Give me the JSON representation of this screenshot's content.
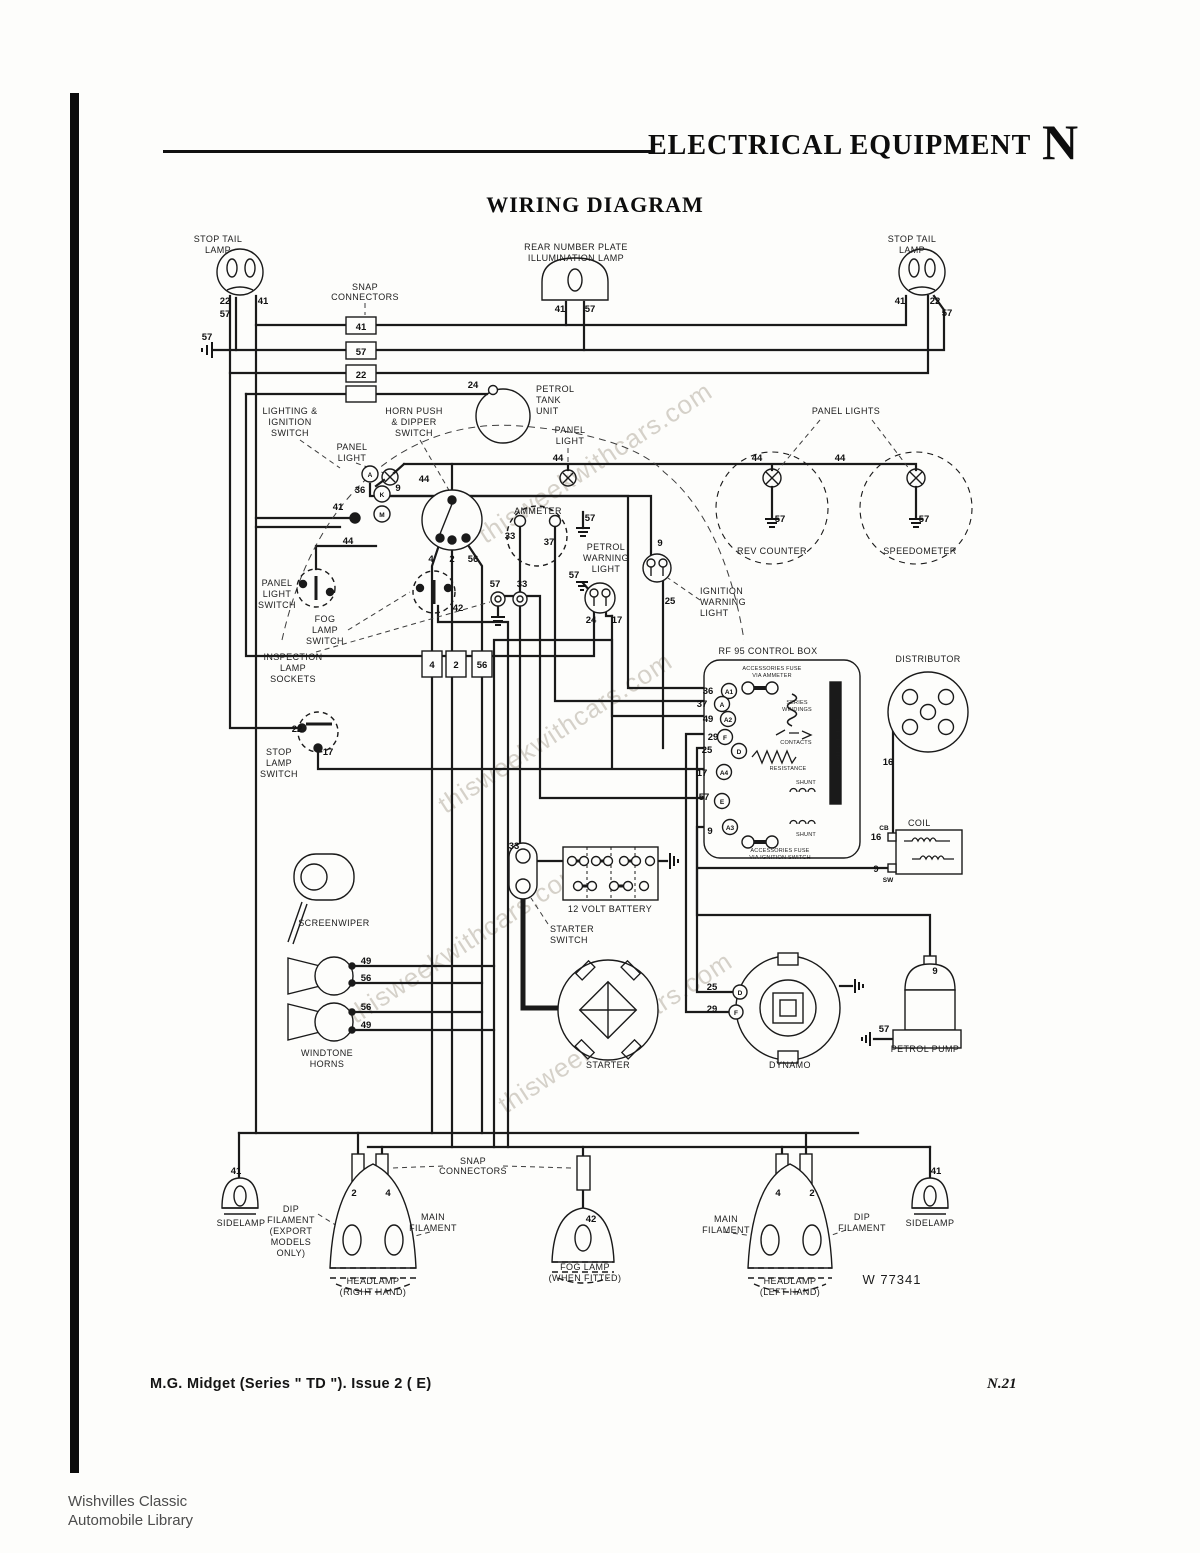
{
  "page": {
    "header": {
      "title": "ELECTRICAL EQUIPMENT",
      "section_letter": "N"
    },
    "diagram_title": "WIRING DIAGRAM",
    "footer": {
      "model_line": "M.G. Midget (Series \" TD \").  Issue 2 ( E)",
      "page_number": "N.21"
    },
    "stamp": {
      "line1": "Wishvilles Classic",
      "line2": "Automobile Library"
    },
    "watermark": "thisweekwithcars.com",
    "drawing_number": "W 77341"
  },
  "labels": {
    "stop_tail_lamp_left": [
      "STOP TAIL",
      "LAMP"
    ],
    "snap_connectors_top": [
      "SNAP",
      "CONNECTORS"
    ],
    "rear_number_plate_lamp": [
      "REAR NUMBER PLATE",
      "ILLUMINATION LAMP"
    ],
    "stop_tail_lamp_right": [
      "STOP TAIL",
      "LAMP"
    ],
    "petrol_tank_unit": [
      "PETROL",
      "TANK",
      "UNIT"
    ],
    "lighting_ignition_switch": [
      "LIGHTING &",
      "IGNITION",
      "SWITCH"
    ],
    "horn_push_dipper_switch": [
      "HORN PUSH",
      "& DIPPER",
      "SWITCH"
    ],
    "panel_light_left": [
      "PANEL",
      "LIGHT"
    ],
    "panel_light_mid": [
      "PANEL",
      "LIGHT"
    ],
    "panel_lights_right": "PANEL LIGHTS",
    "ammeter": "AMMETER",
    "petrol_warning_light": [
      "PETROL",
      "WARNING",
      "LIGHT"
    ],
    "ignition_warning_light": [
      "IGNITION",
      "WARNING",
      "LIGHT"
    ],
    "rev_counter": "REV COUNTER",
    "speedometer": "SPEEDOMETER",
    "panel_light_switch": [
      "PANEL",
      "LIGHT",
      "SWITCH"
    ],
    "fog_lamp_switch": [
      "FOG",
      "LAMP",
      "SWITCH"
    ],
    "inspection_lamp_sockets": [
      "INSPECTION",
      "LAMP",
      "SOCKETS"
    ],
    "stop_lamp_switch": [
      "STOP",
      "LAMP",
      "SWITCH"
    ],
    "control_box": "RF 95 CONTROL BOX",
    "accessories_fuse_ammeter": [
      "ACCESSORIES FUSE",
      "VIA AMMETER"
    ],
    "series_windings": [
      "SERIES",
      "WINDINGS"
    ],
    "contacts": "CONTACTS",
    "resistance": "RESISTANCE",
    "regulator_frame": "REGULATOR FRAME",
    "shunt_upper": "SHUNT",
    "shunt_lower": "SHUNT",
    "accessories_fuse_ignition": [
      "ACCESSORIES FUSE",
      "VIA IGNITION SWITCH"
    ],
    "distributor": "DISTRIBUTOR",
    "coil": "COIL",
    "battery": "12 VOLT BATTERY",
    "starter_switch": [
      "STARTER",
      "SWITCH"
    ],
    "screenwiper": "SCREENWIPER",
    "windtone_horns": [
      "WINDTONE",
      "HORNS"
    ],
    "starter": "STARTER",
    "dynamo": "DYNAMO",
    "petrol_pump": "PETROL PUMP",
    "snap_connectors_bottom": [
      "SNAP",
      "CONNECTORS"
    ],
    "sidelamp_left": "SIDELAMP",
    "dip_filament_export": [
      "DIP",
      "FILAMENT",
      "(EXPORT",
      "MODELS",
      "ONLY)"
    ],
    "main_filament_left": [
      "MAIN",
      "FILAMENT"
    ],
    "fog_lamp": [
      "FOG LAMP",
      "(WHEN FITTED)"
    ],
    "main_filament_right": [
      "MAIN",
      "FILAMENT"
    ],
    "dip_filament_right": [
      "DIP",
      "FILAMENT"
    ],
    "headlamp_right": [
      "HEADLAMP",
      "(RIGHT HAND)"
    ],
    "headlamp_left": [
      "HEADLAMP",
      "(LEFT HAND)"
    ],
    "sidelamp_right": "SIDELAMP"
  },
  "wires": {
    "n2": "2",
    "n4": "4",
    "n9": "9",
    "n16": "16",
    "n17": "17",
    "n22": "22",
    "n24": "24",
    "n25": "25",
    "n29": "29",
    "n33": "33",
    "n36": "36",
    "n37": "37",
    "n41": "41",
    "n42": "42",
    "n44": "44",
    "n49": "49",
    "n56": "56",
    "n57": "57"
  },
  "terminals": {
    "a1": "A1",
    "a": "A",
    "a2": "A2",
    "f": "F",
    "d": "D",
    "a4": "A4",
    "e": "E",
    "a3": "A3",
    "cb": "CB",
    "sw": "SW",
    "k": "K",
    "m": "M"
  }
}
